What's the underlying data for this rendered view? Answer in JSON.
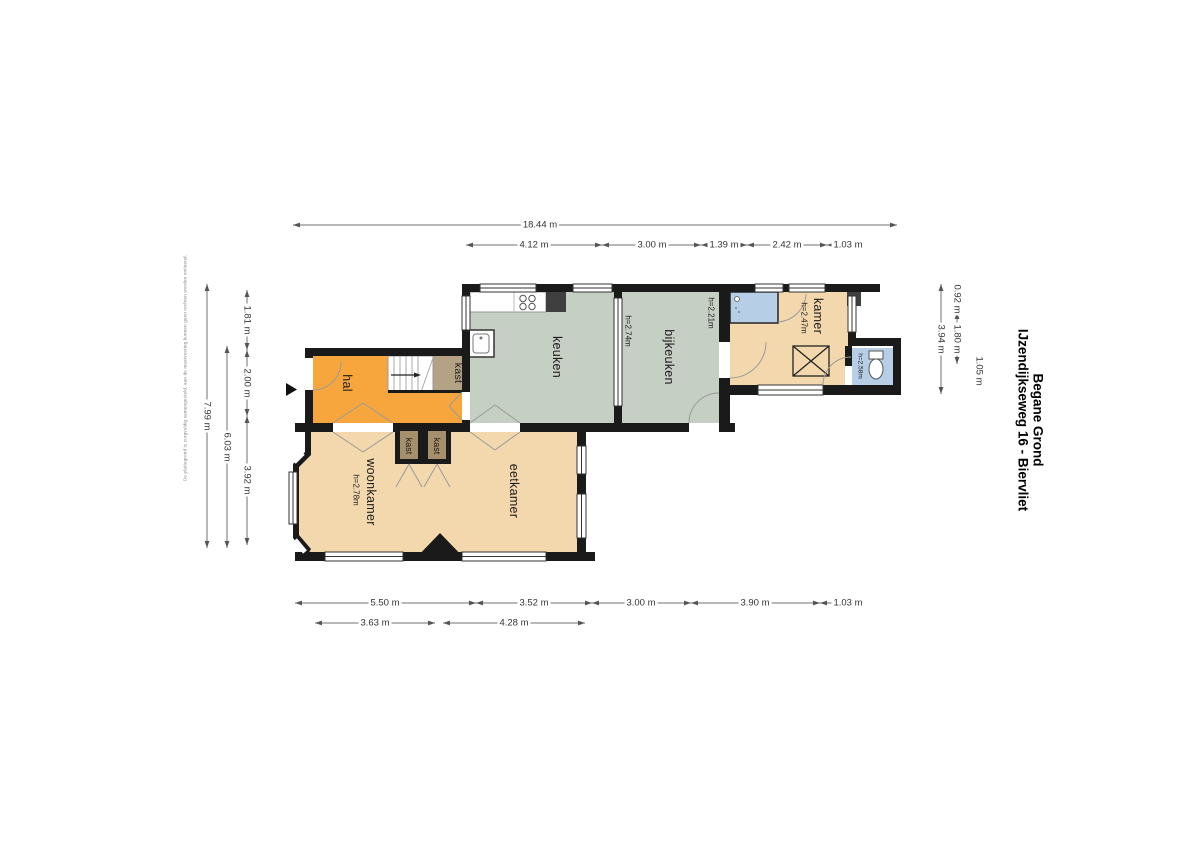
{
  "title": {
    "address": "IJzendijkseweg 16 - Biervliet",
    "floor": "Begane Grond"
  },
  "disclaimer": "De plattegrond is zorgvuldig samengesteld, aan de maatvoering kunnen geen rechten worden ontleend.",
  "rooms": {
    "hal": {
      "label": "hal"
    },
    "kast_hal": {
      "label": "kast"
    },
    "kast_woonkamer": {
      "label": "kast"
    },
    "kast_eetkamer": {
      "label": "kast"
    },
    "woonkamer": {
      "label": "woonkamer",
      "height": "h=2.78m"
    },
    "eetkamer": {
      "label": "eetkamer"
    },
    "keuken": {
      "label": "keuken",
      "height": "h=2.74m"
    },
    "bijkeuken": {
      "label": "bijkeuken",
      "height": "h=2.21m"
    },
    "kamer": {
      "label": "kamer",
      "height": "h=2.47m"
    },
    "badkamer": {
      "height": "h=2.58m"
    }
  },
  "dimensions": {
    "top_total": "18.44 m",
    "top": [
      "4.12 m",
      "3.00 m",
      "1.39 m",
      "2.42 m",
      "1.03 m"
    ],
    "bottom": [
      "5.50 m",
      "3.52 m",
      "3.00 m",
      "3.90 m",
      "1.03 m"
    ],
    "bottom_inner": [
      "3.63 m",
      "4.28 m"
    ],
    "left_inner": [
      "1.81 m",
      "2.00 m",
      "3.92 m"
    ],
    "left_mid": "6.03 m",
    "left_total": "7.99 m",
    "right_inner": [
      "0.92 m",
      "1.80 m"
    ],
    "right_float": "1.05 m",
    "right_total": "3.94 m"
  },
  "colors": {
    "hal": "#F6A63D",
    "living_rooms": "#F2D8AC",
    "kitchen_rooms": "#C6CFC3",
    "closet": "#A5906B",
    "closet_large": "#B3A284",
    "sanitary": "#B7CFE6",
    "walls": "#1a1a1a",
    "dimension_lines": "#707070"
  }
}
